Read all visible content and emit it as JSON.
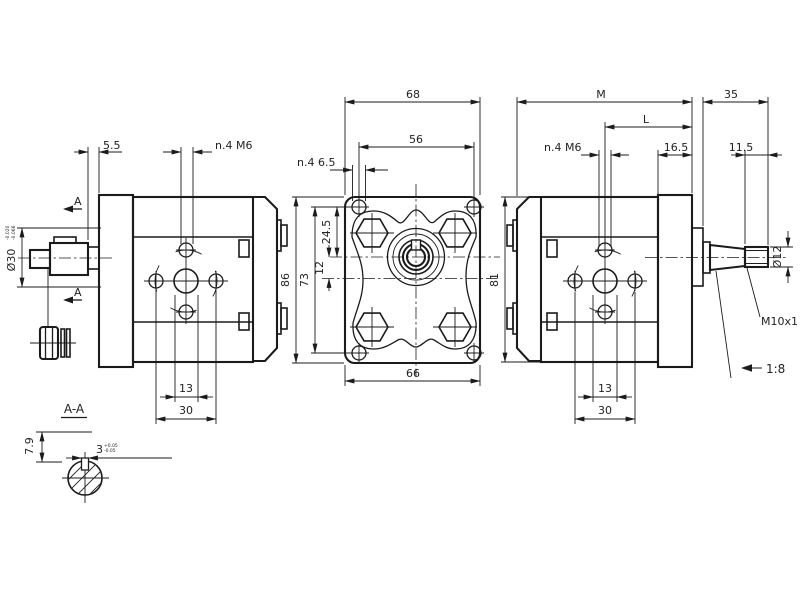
{
  "drawing": {
    "type": "gear-pump dimensional drawing, three orthographic views plus section",
    "left_view": {
      "dim_5_5": "5.5",
      "dim_n4_m6": "n.4 M6",
      "dia_30": "Ø30",
      "dia_30_tol_upper": "-0.020",
      "dia_30_tol_lower": "-0.066",
      "section_arrow": "A",
      "dim_13": "13",
      "dim_30": "30"
    },
    "front_view": {
      "dim_68": "68",
      "dim_56": "56",
      "dim_n4_6_5": "n.4 6.5",
      "dim_86": "86",
      "dim_73": "73",
      "dim_24_5": "24.5",
      "dim_12": "12",
      "dim_66": "66"
    },
    "right_view": {
      "dim_M": "M",
      "dim_35": "35",
      "dim_L": "L",
      "dim_16_5": "16.5",
      "dim_11_5": "11.5",
      "dim_n4_m6": "n.4 M6",
      "dim_81": "81",
      "dim_13": "13",
      "dim_30": "30",
      "dia_12": "Ø12",
      "thread_label": "M10x1",
      "taper_label": "1:8"
    },
    "section_view": {
      "title": "A-A",
      "dim_7_9": "7.9",
      "dim_3": "3",
      "dim_3_tol_upper": "+0.05",
      "dim_3_tol_lower": "-0.05"
    },
    "colors": {
      "line": "#1b1b1b",
      "background": "#ffffff"
    }
  }
}
